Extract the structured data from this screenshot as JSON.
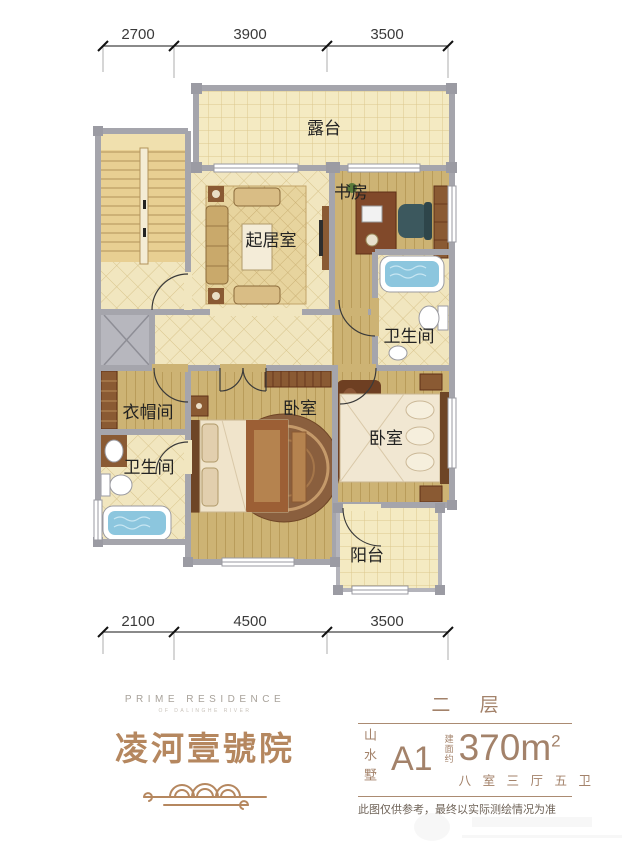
{
  "dimensions": {
    "top": [
      "2700",
      "3900",
      "3500"
    ],
    "bottom": [
      "2100",
      "4500",
      "3500"
    ]
  },
  "rooms": {
    "terrace": "露台",
    "study": "书房",
    "living_room": "起居室",
    "bathroom_top": "卫生间",
    "cloakroom": "衣帽间",
    "master_bedroom": "卧室",
    "bathroom_bottom": "卫生间",
    "second_bedroom": "卧室",
    "balcony": "阳台"
  },
  "branding": {
    "logo_en": "PRIME RESIDENCE",
    "logo_en_sub": "OF DALINGHE RIVER",
    "logo_cn": "凌河壹號院"
  },
  "info_panel": {
    "floor_label": "二 层",
    "series_vertical": "山水墅",
    "unit_code": "A1",
    "area_prefix_vertical": "建面约",
    "area_value": "370m",
    "area_superscript": "2",
    "layout_spec": "八 室 三 厅 五 卫",
    "disclaimer": "此图仅供参考，最终以实际测绘情况为准"
  },
  "colors": {
    "accent_tan": "#a3826a",
    "calligraphy_tan": "#b5875f",
    "wall_gray": "#a5a5ac",
    "tile_cream": "#f3e9c0",
    "wood_tan": "#cdb374",
    "water_blue": "#8cc6de",
    "label_dark": "#222222"
  }
}
